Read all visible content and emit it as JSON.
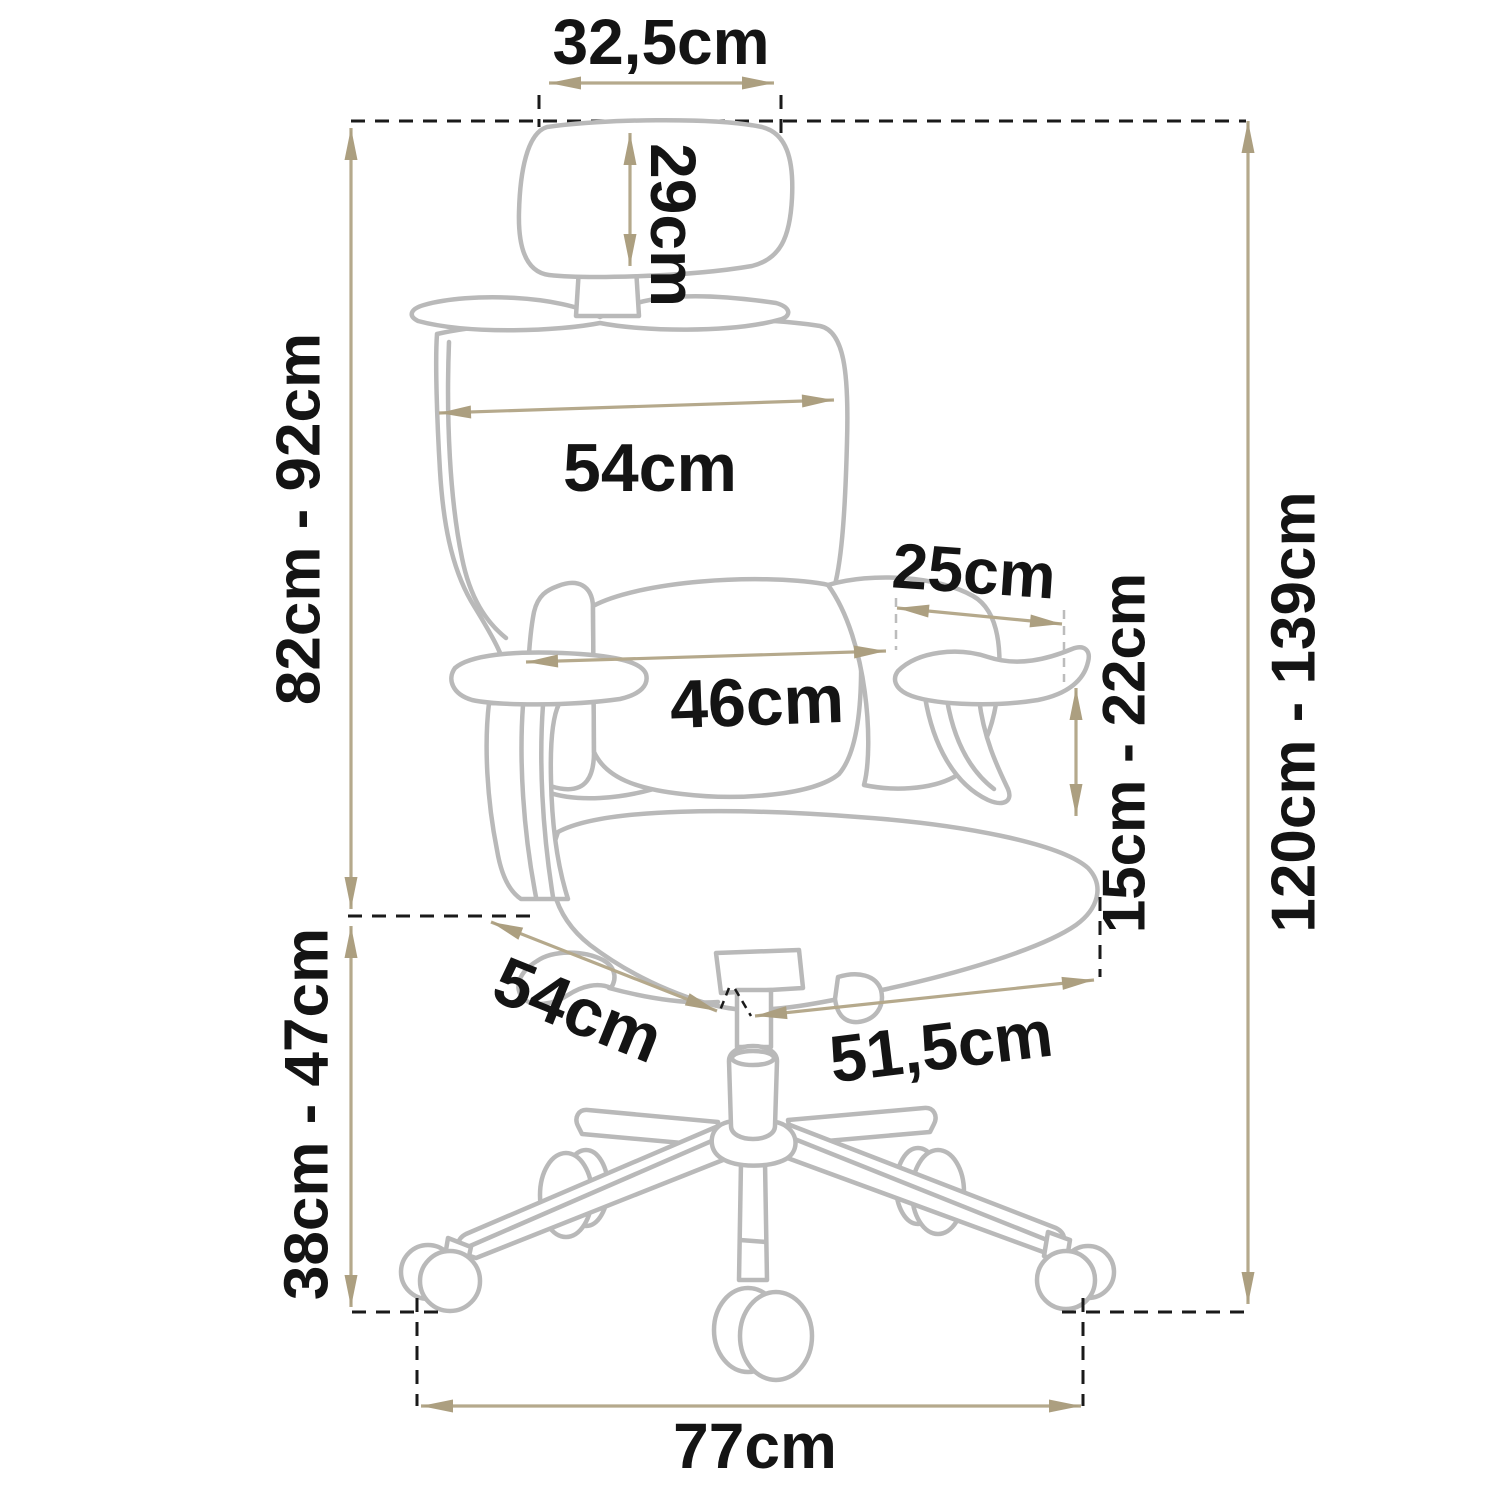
{
  "diagram": {
    "subject": "ergonomic office chair dimension drawing",
    "unit": "cm",
    "labels": {
      "headrest_width": "32,5cm",
      "headrest_height": "29cm",
      "backrest_width": "54cm",
      "lumbar_width": "46cm",
      "armrest_pad_length": "25cm",
      "armrest_height_range": "15cm - 22cm",
      "backrest_height_range": "82cm - 92cm",
      "total_height_range": "120cm - 139cm",
      "seat_depth": "54cm",
      "seat_width": "51,5cm",
      "seat_height_range": "38cm - 47cm",
      "base_width": "77cm"
    },
    "colors": {
      "dimension_line": "#b5a98c",
      "arrow_head": "#ac9f80",
      "chair_outline": "#b9b9b9",
      "guide_dash": "#1a1a1a",
      "text": "#141414"
    }
  }
}
